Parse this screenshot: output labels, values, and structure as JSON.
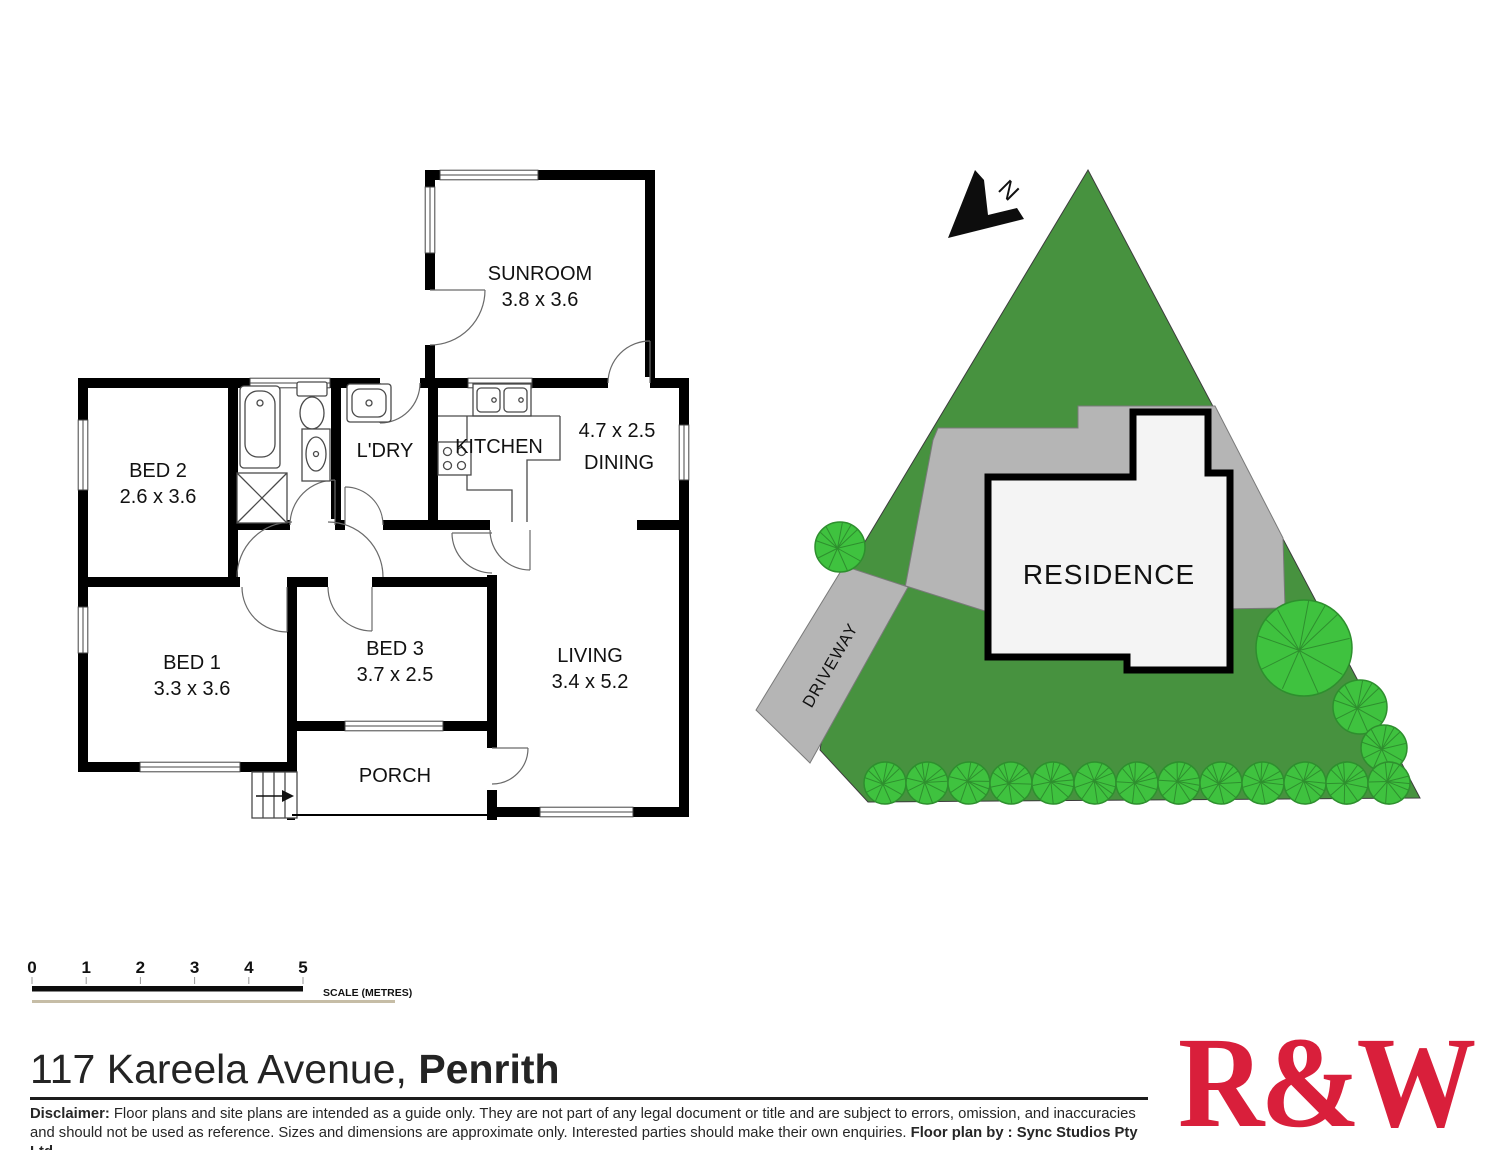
{
  "floor_plan": {
    "rooms": {
      "sunroom": {
        "name": "SUNROOM",
        "dims": "3.8 x 3.6"
      },
      "bed2": {
        "name": "BED 2",
        "dims": "2.6 x 3.6"
      },
      "ldry": {
        "name": "L'DRY"
      },
      "kitchen": {
        "name": "KITCHEN"
      },
      "dining": {
        "name": "DINING",
        "dims": "4.7 x 2.5"
      },
      "bed1": {
        "name": "BED 1",
        "dims": "3.3 x 3.6"
      },
      "bed3": {
        "name": "BED 3",
        "dims": "3.7 x 2.5"
      },
      "living": {
        "name": "LIVING",
        "dims": "3.4 x 5.2"
      },
      "porch": {
        "name": "PORCH"
      }
    }
  },
  "site_plan": {
    "residence_label": "RESIDENCE",
    "driveway_label": "DRIVEWAY",
    "north_label": "N"
  },
  "scale_bar": {
    "ticks": [
      "0",
      "1",
      "2",
      "3",
      "4",
      "5"
    ],
    "caption": "SCALE (METRES)"
  },
  "address": {
    "street": "117 Kareela Avenue, ",
    "suburb": "Penrith"
  },
  "disclaimer": {
    "label": "Disclaimer:",
    "body": " Floor plans and site plans are intended as a guide only. They are not part of any legal document or title and are subject to errors, omission, and inaccuracies and should not be used as reference. Sizes and dimensions are approximate only. Interested parties should make their own enquiries. ",
    "credit": "Floor plan by : Sync Studios Pty Ltd"
  },
  "logo": {
    "text": "R&W"
  },
  "colors": {
    "lot_green": "#47923f",
    "shrub_green": "#3fc23f",
    "shrub_outline": "#2e8f2e",
    "paved_gray": "#b5b5b5",
    "logo_red": "#d91f3b"
  }
}
